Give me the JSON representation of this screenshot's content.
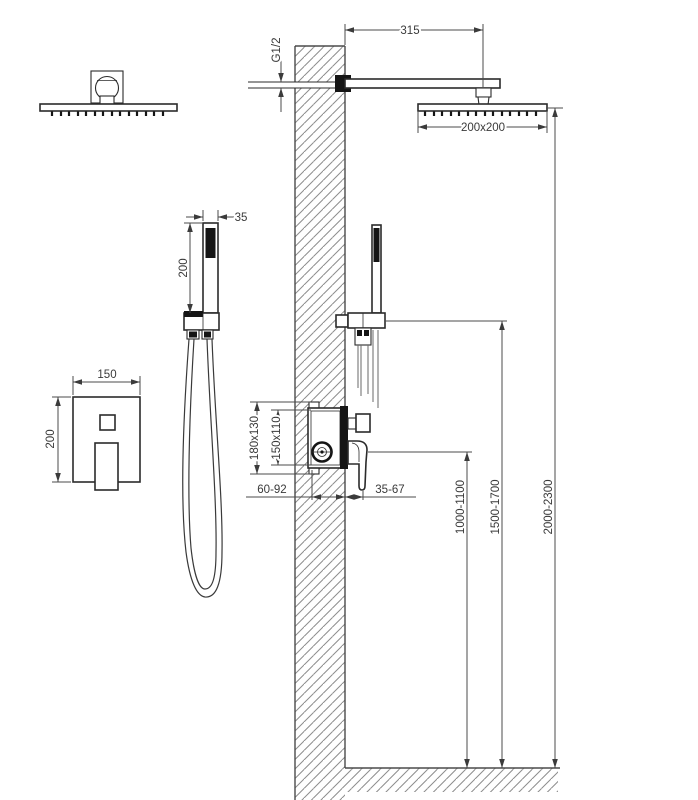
{
  "drawing": {
    "title": "shower-system-installation-diagram",
    "dimensions": {
      "arm_length": "315",
      "inlet_thread": "G1/2",
      "head_size": "200x200",
      "handshower_width": "35",
      "handshower_length": "200",
      "mixer_plate_width": "150",
      "mixer_plate_height": "200",
      "valve_rough_outer": "180x130",
      "valve_rough_inner": "150x110",
      "valve_depth_range": "60-92",
      "trim_depth_range": "35-67",
      "mixer_height_range": "1000-1100",
      "handshower_height_range": "1500-1700",
      "head_height_range": "2000-2300"
    }
  }
}
